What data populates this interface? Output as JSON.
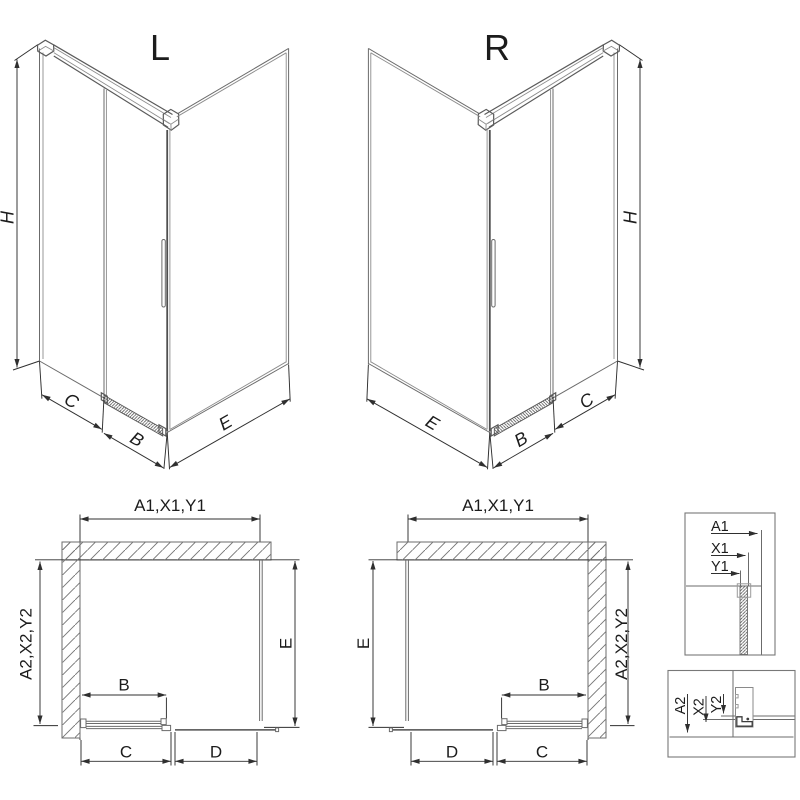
{
  "figures": {
    "iso_left": {
      "title": "L",
      "height": "H",
      "c": "C",
      "b": "B",
      "e": "E"
    },
    "iso_right": {
      "title": "R",
      "height": "H",
      "e": "E",
      "b": "B",
      "c": "C"
    },
    "plan_left": {
      "width": "A1,X1,Y1",
      "depth": "A2,X2,Y2",
      "door": "B",
      "side": "E",
      "fixed": "C",
      "opening": "D"
    },
    "plan_right": {
      "width": "A1,X1,Y1",
      "depth": "A2,X2,Y2",
      "door": "B",
      "side": "E",
      "fixed": "C",
      "opening": "D"
    },
    "detail_top": {
      "a": "A1",
      "x": "X1",
      "y": "Y1"
    },
    "detail_bottom": {
      "a": "A2",
      "x": "X2",
      "y": "Y2"
    }
  },
  "colors": {
    "figure_line": "#6b6b6b",
    "dimension_line": "#2f2f2f",
    "text": "#1c1c1c",
    "hatch": "#767676",
    "background": "#ffffff"
  }
}
